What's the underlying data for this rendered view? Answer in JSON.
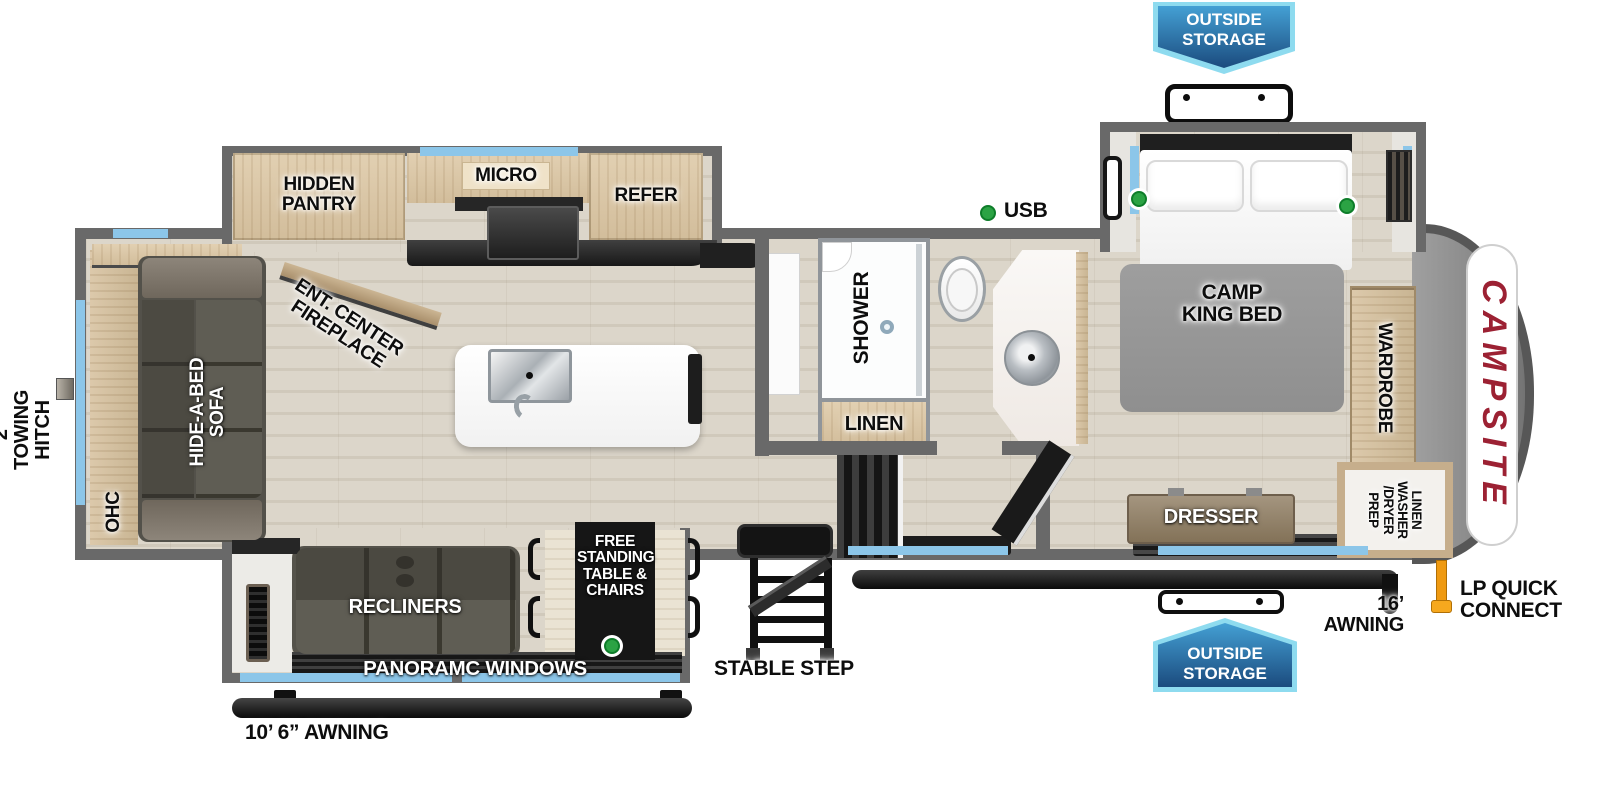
{
  "colors": {
    "wall_gray": "#696969",
    "window_blue": "#8cc6e9",
    "badge_blue_dark": "#1b4b7e",
    "badge_blue_light": "#44a0d4",
    "badge_border": "#8edbef",
    "logo_red": "#9c2133",
    "green_dot": "#2ba344",
    "lp_orange": "#ef9a12",
    "awning_black": "#111111"
  },
  "badges": {
    "outside_storage_top": "OUTSIDE\nSTORAGE",
    "outside_storage_bottom": "OUTSIDE\nSTORAGE"
  },
  "exterior": {
    "towing_hitch": "2”\nTOWING\nHITCH",
    "awning_left": "10’ 6” AWNING",
    "awning_right": "16’ AWNING",
    "lp_quick_connect": "LP QUICK\nCONNECT",
    "stable_step": "STABLE STEP",
    "logo": "CAMPSITE"
  },
  "kitchen": {
    "hidden_pantry": "HIDDEN\nPANTRY",
    "micro": "MICRO",
    "refer": "REFER"
  },
  "living": {
    "ohc": "OHC",
    "sofa": "HIDE-A-BED\nSOFA",
    "ent_center": "ENT. CENTER\nFIREPLACE",
    "recliners": "RECLINERS",
    "table": "FREE\nSTANDING\nTABLE &\nCHAIRS",
    "panoramic_windows": "PANORAMC WINDOWS"
  },
  "bath": {
    "shower": "SHOWER",
    "linen": "LINEN"
  },
  "bedroom": {
    "usb": "USB",
    "bed": "CAMP\nKING BED",
    "wardrobe": "WARDROBE",
    "dresser": "DRESSER",
    "washer_dryer": "LINEN\nWASHER\n/DRYER\nPREP"
  }
}
